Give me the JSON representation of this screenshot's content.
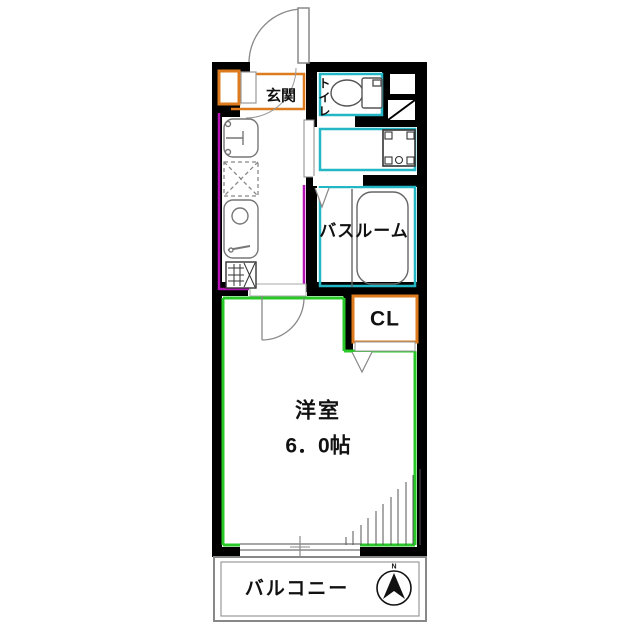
{
  "floorplan": {
    "labels": {
      "genkan": "玄関",
      "toilet": "トイレ",
      "bathroom": "バスルーム",
      "closet": "CL",
      "room_name": "洋室",
      "room_size": "6．0帖",
      "balcony": "バルコニー",
      "compass_north": "N"
    },
    "colors": {
      "wall": "#000000",
      "genkan_closet_accent": "#dd7b1e",
      "kitchen_accent": "#b412b4",
      "wet_area_accent": "#23b7c6",
      "room_accent": "#28c828",
      "fixture_line": "#777777",
      "background": "#ffffff"
    },
    "icons": {
      "entrance_door": "entrance-door-swing-icon",
      "room_door": "room-door-swing-icon",
      "closet_door": "folding-door-icon",
      "bathroom_door": "folding-door-icon",
      "toilet": "toilet-bowl-icon",
      "bathtub": "bathtub-icon",
      "washing_machine": "washer-pan-icon",
      "wash_basin": "wash-basin-icon",
      "kitchen_sink": "kitchen-sink-icon",
      "stove": "stove-icon",
      "refrigerator_space": "refrigerator-space-icon",
      "window": "sliding-window-icon",
      "compass": "north-compass-icon"
    }
  }
}
